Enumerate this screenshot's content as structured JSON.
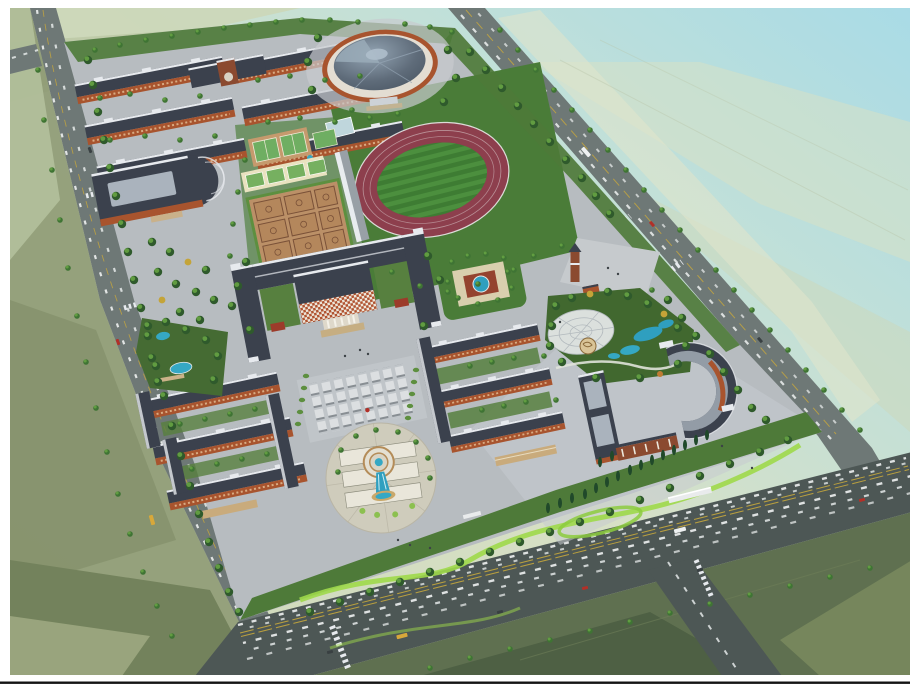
{
  "meta": {
    "width": 910,
    "height": 687,
    "kind": "aerial-architectural-rendering",
    "subject": "school-campus-master-plan"
  },
  "palette": {
    "frame_white": "#ffffff",
    "frame_line": "#141414",
    "sky": "#a9dbe6",
    "field_pale": "#d7e0c6",
    "field_light": "#ccd7b8",
    "field_mid": "#b7c4a0",
    "field_olive": "#8e9a74",
    "field_olive_dark": "#73825c",
    "field_bottom": "#5f7050",
    "field_bottom_dark": "#4e6044",
    "field_bottom_light": "#76865c",
    "road": "#6e7876",
    "road_dark": "#4d5755",
    "lane_yellow": "#c8a83c",
    "car_white": "#eef1f1",
    "car_dark": "#394042",
    "car_red": "#b23028",
    "car_yellow": "#d8a83a",
    "paving": "#b7bcc0",
    "paving_light": "#c7cbcf",
    "plaza_cream": "#e9e6da",
    "plaza_ring": "#cfccbc",
    "lawn": "#4a7c38",
    "lawn_bright": "#9fd94a",
    "belt": "#4e7a39",
    "hedge": "#5d8f3f",
    "courtyard": "#57803f",
    "tree_dark": "#2f5a2c",
    "tree_mid": "#3f7434",
    "tree_light": "#6aa845",
    "tree_yellow": "#c4a438",
    "tree_orange": "#c07c34",
    "conifer": "#20492a",
    "roof": "#3b414d",
    "roof_light": "#aab3bd",
    "ridge": "#e7eaee",
    "brick": "#a8542e",
    "brick_dark": "#8b4a30",
    "facade_red": "#b0522f",
    "track": "#8d3f4d",
    "infield": "#3e7c33",
    "infield_stripe": "#4c8f3e",
    "stand": "#e8ecef",
    "court_tan": "#c59a6d",
    "court_green": "#6fae62",
    "court_cream": "#e9e2c0",
    "bball_tan": "#bb9067",
    "bball_line": "#7a5138",
    "water": "#35a8c4",
    "water_deep": "#2f9fbf",
    "pond_rim": "#b48c58",
    "lattice": "#e4e7e7",
    "garden_red": "#94432f"
  },
  "features": [
    "perimeter-roads",
    "dormitory-area-north",
    "gate-building",
    "canteen-building",
    "gymnasium",
    "running-track",
    "grandstand",
    "tennis-courts",
    "volleyball-courts",
    "basketball-courts",
    "main-teaching-complex",
    "chess-plaza",
    "square-pond-garden",
    "entrance-plaza",
    "clock-tower",
    "lattice-dome-garden",
    "classroom-cluster-east",
    "auditorium-building",
    "dormitory-quad-south",
    "fountain-plaza",
    "pond-garden",
    "green-belts",
    "farm-fields",
    "south-gate"
  ]
}
